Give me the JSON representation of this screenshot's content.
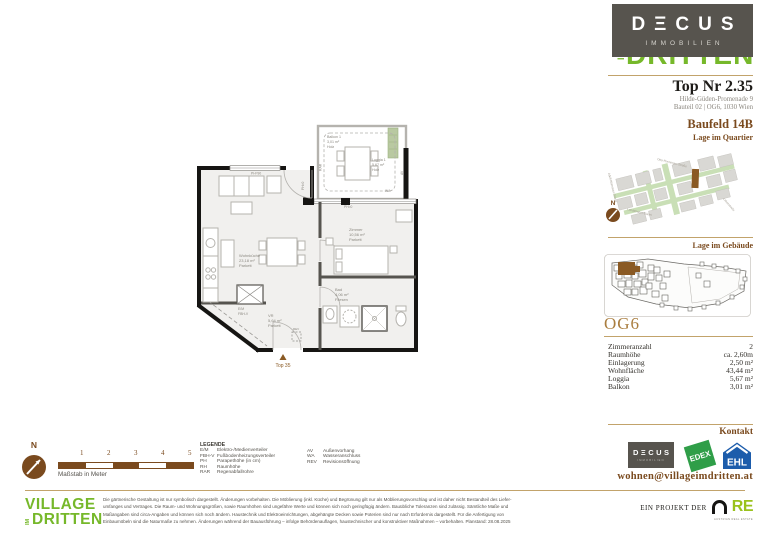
{
  "header": {
    "top_nr": "Top Nr 2.35",
    "address_line1": "Hilde-Güden-Promenade 9",
    "address_line2": "Bauteil 02 | OG6, 1030 Wien"
  },
  "brand": {
    "decus_stylized": "DΞCUS",
    "immobilien": "IMMOBILIEN"
  },
  "village": {
    "line1": "VILLAGE",
    "im": "IM",
    "line2": "DRITTEN"
  },
  "quartier": {
    "title": "Baufeld 14B",
    "subtitle": "Lage im Quartier",
    "compass_n": "N",
    "streets": [
      "Otto-Preminger-Straße",
      "Landstraßer Gürtel",
      "Leberstraße",
      "Adolf-Blamauer-Gasse"
    ]
  },
  "gebaeude": {
    "title": "Lage im Gebäude",
    "floor_label": "OG6"
  },
  "facts": {
    "rows": [
      {
        "label": "Zimmeranzahl",
        "value": "2"
      },
      {
        "label": "Raumhöhe",
        "value": "ca. 2,60m"
      },
      {
        "label": "Einlagerung",
        "value": "2,50 m²"
      },
      {
        "label": "Wohnfläche",
        "value": "43,44 m²"
      },
      {
        "label": "Loggia",
        "value": "5,67 m²"
      },
      {
        "label": "Balkon",
        "value": "3,01 m²"
      }
    ]
  },
  "kontakt": {
    "title": "Kontakt",
    "email": "wohnen@villageimdritten.at",
    "edex": "EDEX",
    "ehl": "EHL",
    "project_prefix": "EIN PROJEKT DER",
    "are": "RE",
    "are_sub": "AUSTRIAN REAL ESTATE"
  },
  "plan": {
    "rooms": [
      {
        "name": "Wohnküche",
        "area": "23,18 m²",
        "floor": "Parkett"
      },
      {
        "name": "Zimmer",
        "area": "10,56 m²",
        "floor": "Parkett"
      },
      {
        "name": "Bad",
        "area": "4,06 m²",
        "floor": "Fliesen"
      },
      {
        "name": "VR",
        "area": "5,64 m²",
        "floor": "Parkett"
      },
      {
        "name": "Balkon 1",
        "area": "3,01 m²",
        "floor": "Holz"
      },
      {
        "name": "Loggia 1",
        "area": "5,67 m²",
        "floor": "Holz"
      }
    ],
    "ann": {
      "em": "E/M",
      "fbhv": "FBH-V",
      "rev": "REV",
      "rar": "RAR",
      "av": "AV",
      "wa": "WA",
      "ph0": "PH=0",
      "ph90": "PH=90",
      "entry": "Top 35"
    }
  },
  "scalebar": {
    "numbers": [
      "1",
      "2",
      "3",
      "4",
      "5"
    ],
    "caption": "Maßstab in Meter",
    "compass_n": "N"
  },
  "legend": {
    "title": "LEGENDE",
    "col1": [
      {
        "abbr": "E/M",
        "text": "Elektro-/Medienverteiler"
      },
      {
        "abbr": "FBH-V",
        "text": "Fußbodenheizungsverteiler"
      },
      {
        "abbr": "PH",
        "text": "Parapethöhe (in cm)"
      },
      {
        "abbr": "RH",
        "text": "Raumhöhe"
      },
      {
        "abbr": "RAR",
        "text": "Regenabfallrohre"
      }
    ],
    "col2": [
      {
        "abbr": "AV",
        "text": "Außenvorhang"
      },
      {
        "abbr": "WA",
        "text": "Wasseranschluss"
      },
      {
        "abbr": "REV",
        "text": "Revisionsöffnung"
      }
    ]
  },
  "footer": {
    "disclaimer": [
      "Die gärtnerische Gestaltung ist nur symbolisch dargestellt. Änderungen vorbehalten. Die Möblierung (inkl. Küche) und Begrünung gilt nur als Möblierungsvorschlag und ist daher nicht Bestandteil des Liefer-",
      "umfanges und Vertrages. Die Raum- und Wohnungsgrößen, sowie Raumhöhen sind ungefähre Werte und können sich noch geringfügig ändern. Bauübliche Toleranzen sind zulässig. Sämtliche Maße und",
      "Maßangaben sind circa-Angaben und können sich noch ändern. Haustechnik und Elektroeinrichtungen, abgehängte Decken sowie Poterien sind nur nach Erfordernis dargestellt. Für die Anfertigung von",
      "Einbaumöbeln sind die Naturmaße zu nehmen. Änderungen während der Bauausführung – infolge Behördenauflagen, haustechnischer und konstruktiver Maßnahmen – vorbehalten. Planstand: 28.08.2025"
    ]
  },
  "colors": {
    "brown": "#7a4a1e",
    "gold": "#c2a36b",
    "green": "#76b82a",
    "dark_box": "#57544e",
    "edex_green": "#2f9e48",
    "ehl_blue": "#1c5cab",
    "are_green": "#9ac21c",
    "unit_brown": "#8a5a24"
  }
}
